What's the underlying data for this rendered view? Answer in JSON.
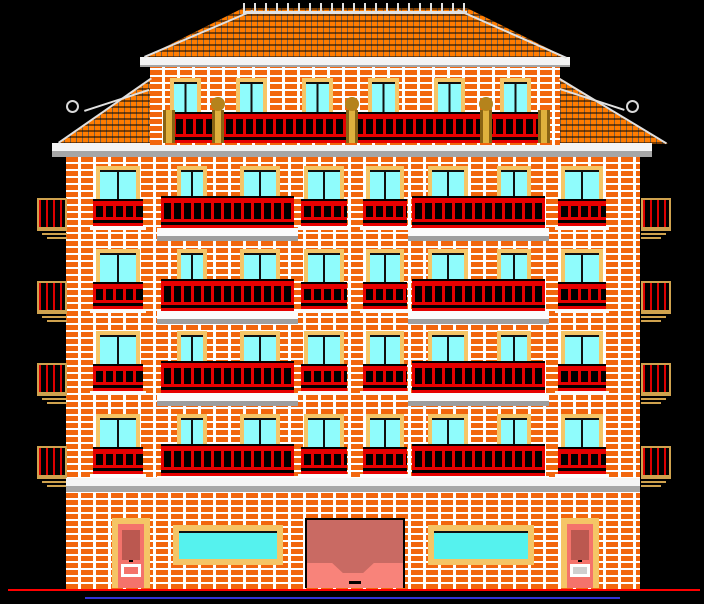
{
  "drawing": {
    "type": "architectural-elevation",
    "subject": "six-storey brick apartment building, front elevation, CAD raster on black background"
  },
  "palette": {
    "background": "#000000",
    "brick": "#f2660d",
    "mortar": "#ffffff",
    "roof_tile": "#ff7c00",
    "cornice_white": "#f4f4f4",
    "cornice_gray": "#a6a6a6",
    "window_frame": "#f5c566",
    "glass_pale": "#8ffcfc",
    "glass_aqua": "#55f2ee",
    "railing_red": "#e60000",
    "railing_dark": "#000000",
    "post_brown": "#a87a1a",
    "side_balcony_tan": "#cfa24e",
    "door_salmon": "#f4736b",
    "door_panel": "#bb5850",
    "garage_body": "#c96a63",
    "garage_ramp": "#f8837a",
    "ground_line_red": "#ff0000",
    "base_line_blue": "#3232d8"
  },
  "canvas": {
    "w": 704,
    "h": 604
  },
  "roof": {
    "hip": {
      "x": 143,
      "y": 8,
      "w": 424,
      "h": 50
    },
    "ridge": {
      "x": 243,
      "y": 3,
      "w": 224,
      "h": 8
    },
    "pent_left": {
      "x": 58,
      "y": 78,
      "w": 94,
      "h": 66
    },
    "pent_right": {
      "x": 560,
      "y": 78,
      "w": 108,
      "h": 66
    },
    "cornice_top": {
      "x": 140,
      "y": 57,
      "w": 430,
      "h": 10
    },
    "cornice_main": {
      "x": 52,
      "y": 143,
      "w": 600,
      "h": 14
    },
    "edge_lines": [
      {
        "x": 144,
        "y": 56,
        "len": 118,
        "deg": -23.1
      },
      {
        "x": 458,
        "y": 9,
        "len": 119,
        "deg": 23.8
      },
      {
        "x": 560,
        "y": 78,
        "len": 125,
        "deg": 31.1
      },
      {
        "x": 58,
        "y": 142,
        "len": 113,
        "deg": -34.8
      },
      {
        "x": 560,
        "y": 88,
        "len": 68,
        "deg": 18
      },
      {
        "x": 84,
        "y": 110,
        "len": 68,
        "deg": -18
      }
    ],
    "ornaments": [
      {
        "x": 66,
        "y": 100,
        "d": 13
      },
      {
        "x": 626,
        "y": 100,
        "d": 13
      }
    ]
  },
  "attic": {
    "wall": {
      "x": 150,
      "y": 66,
      "w": 410,
      "h": 79
    },
    "windows": {
      "xs": [
        170,
        236,
        302,
        368,
        434,
        500
      ],
      "y": 78,
      "w": 31,
      "h": 52
    },
    "railing": {
      "x": 163,
      "y": 112,
      "w": 384,
      "h": 31
    },
    "posts": [
      {
        "x": 163,
        "ball": false
      },
      {
        "x": 212,
        "ball": true
      },
      {
        "x": 346,
        "ball": true
      },
      {
        "x": 480,
        "ball": true
      },
      {
        "x": 538,
        "ball": false
      }
    ],
    "post": {
      "y": 110,
      "w": 12,
      "h": 33,
      "ball_d": 14
    }
  },
  "facade": {
    "x": 66,
    "y": 157,
    "w": 574,
    "h": 432
  },
  "floors": {
    "tops": [
      166,
      249,
      331,
      414
    ],
    "window_h": 56,
    "door_h": 62,
    "windows": [
      {
        "x": 96,
        "w": 44
      },
      {
        "x": 304,
        "w": 40
      },
      {
        "x": 366,
        "w": 38
      },
      {
        "x": 561,
        "w": 42
      }
    ],
    "french": {
      "dy": 33,
      "h": 27,
      "pad": 3,
      "sill_h": 4
    },
    "balconies": [
      {
        "x": 161,
        "w": 133,
        "doors": [
          {
            "x": 177,
            "w": 30
          },
          {
            "x": 240,
            "w": 40
          }
        ]
      },
      {
        "x": 412,
        "w": 133,
        "doors": [
          {
            "x": 428,
            "w": 40
          },
          {
            "x": 497,
            "w": 34
          }
        ]
      }
    ],
    "rail": {
      "dy": 30,
      "h": 32
    },
    "slab": {
      "dy": 62,
      "h": 13,
      "pad": 4
    },
    "side_left_x": 37,
    "side_right_x": 641,
    "side": {
      "dy": 32,
      "w": 30,
      "h": 31
    },
    "side_slab_widths": [
      30,
      25,
      20
    ]
  },
  "ground": {
    "band": {
      "x": 66,
      "y": 478,
      "w": 574,
      "h": 14
    },
    "doors": [
      {
        "x": 112,
        "lower_fill": "none"
      },
      {
        "x": 561,
        "lower_fill": "#cfcfcf"
      }
    ],
    "door": {
      "y": 518,
      "frame_w": 38,
      "frame_h": 70
    },
    "shops": [
      {
        "x": 173,
        "w": 110
      },
      {
        "x": 428,
        "w": 106
      }
    ],
    "shop": {
      "y": 525,
      "h": 40
    },
    "garage": {
      "x": 305,
      "y": 518,
      "w": 100,
      "h": 70,
      "ramp_h": 25
    },
    "red_line": {
      "x": 8,
      "y": 589,
      "w": 692,
      "h": 2
    },
    "blue_line": {
      "x": 85,
      "y": 597,
      "w": 535,
      "h": 2
    }
  }
}
